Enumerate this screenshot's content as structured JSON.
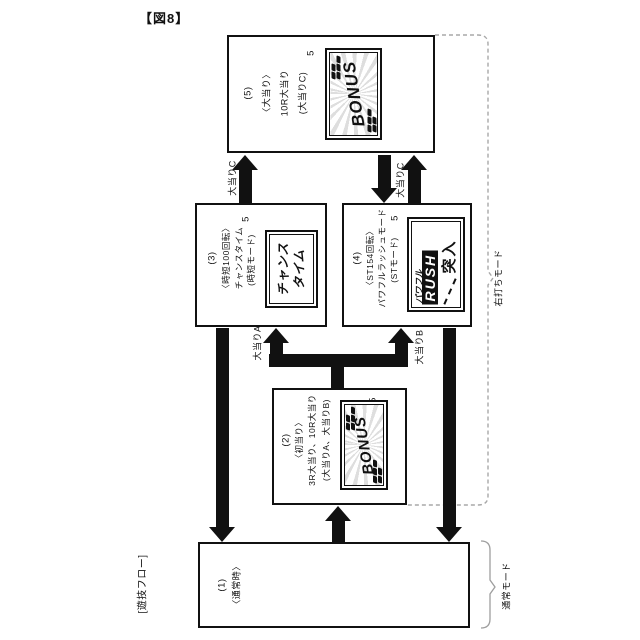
{
  "figure_label": "【図8】",
  "flow_label": "[遊技フロー]",
  "colors": {
    "line": "#111111",
    "bracket": "#9e9e9e"
  },
  "boxes": {
    "jackpot": {
      "number": "(5)",
      "name": "〈大当り〉",
      "detail": "10R大当り",
      "sub": "(大当りC)",
      "ref": "5",
      "logo": {
        "text": "BONUS"
      }
    },
    "chance": {
      "number": "(3)",
      "name": "〈時短100回転〉",
      "detail": "チャンスタイム",
      "sub": "(時短モード)",
      "ref": "5",
      "logo": {
        "line1": "チャンス",
        "line2": "タイム"
      }
    },
    "rush": {
      "number": "(4)",
      "name": "〈ST154回転〉",
      "detail": "パワフルラッシュモード",
      "sub": "(STモード)",
      "ref": "5",
      "logo": {
        "line1": "パワフル",
        "line2": "RUSH",
        "line3": "突入"
      }
    },
    "first_hit": {
      "number": "(2)",
      "name": "〈初当り〉",
      "detail": "3R大当り、10R大当り",
      "sub": "(大当りA、大当りB)",
      "ref": "5",
      "logo": {
        "text": "BONUS"
      }
    },
    "normal": {
      "number": "(1)",
      "name": "〈通常時〉"
    }
  },
  "arrow_labels": {
    "c_left": "大当りC",
    "c_right": "大当りC",
    "a": "大当りA",
    "b": "大当りB"
  },
  "mode_labels": {
    "right_hit": "右打ちモード",
    "normal": "通常モード"
  }
}
